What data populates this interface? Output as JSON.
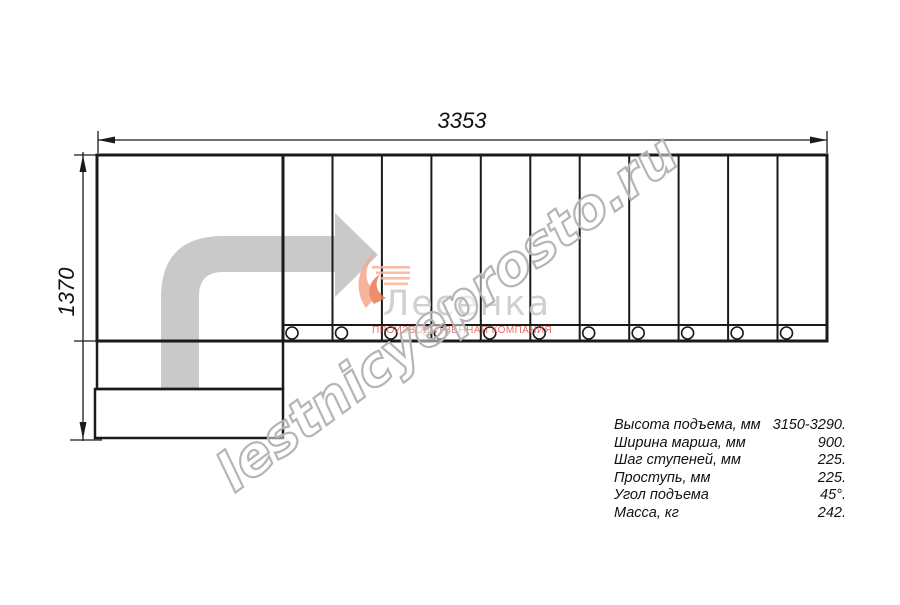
{
  "dimensions": {
    "total_length_mm": "3353",
    "total_width_mm": "1370"
  },
  "specs": {
    "rows": [
      {
        "label": "Высота подъема, мм",
        "value": "3150-3290."
      },
      {
        "label": "Ширина марша, мм",
        "value": "900."
      },
      {
        "label": "Шаг ступеней, мм",
        "value": "225."
      },
      {
        "label": "Проступь, мм",
        "value": "225."
      },
      {
        "label": "Угол подъема",
        "value": "45°."
      },
      {
        "label": "Масса, кг",
        "value": "242."
      }
    ]
  },
  "watermark": {
    "text": "lestnicyeprosto.ru"
  },
  "logo": {
    "name": "Лесенка",
    "tagline": "производственная компания"
  },
  "drawing": {
    "straight_steps": 11,
    "mount_holes": 11,
    "landing_steps": 2,
    "direction_arrow": "turn-right-then-straight"
  },
  "colors": {
    "line": "#1a1a1a",
    "arrow": "#c9c9c9",
    "watermark": "#b5b5b5",
    "logo_text": "#c8c8c8",
    "logo_accent": "#ec7a52",
    "logo_tagline": "#e2574b"
  }
}
